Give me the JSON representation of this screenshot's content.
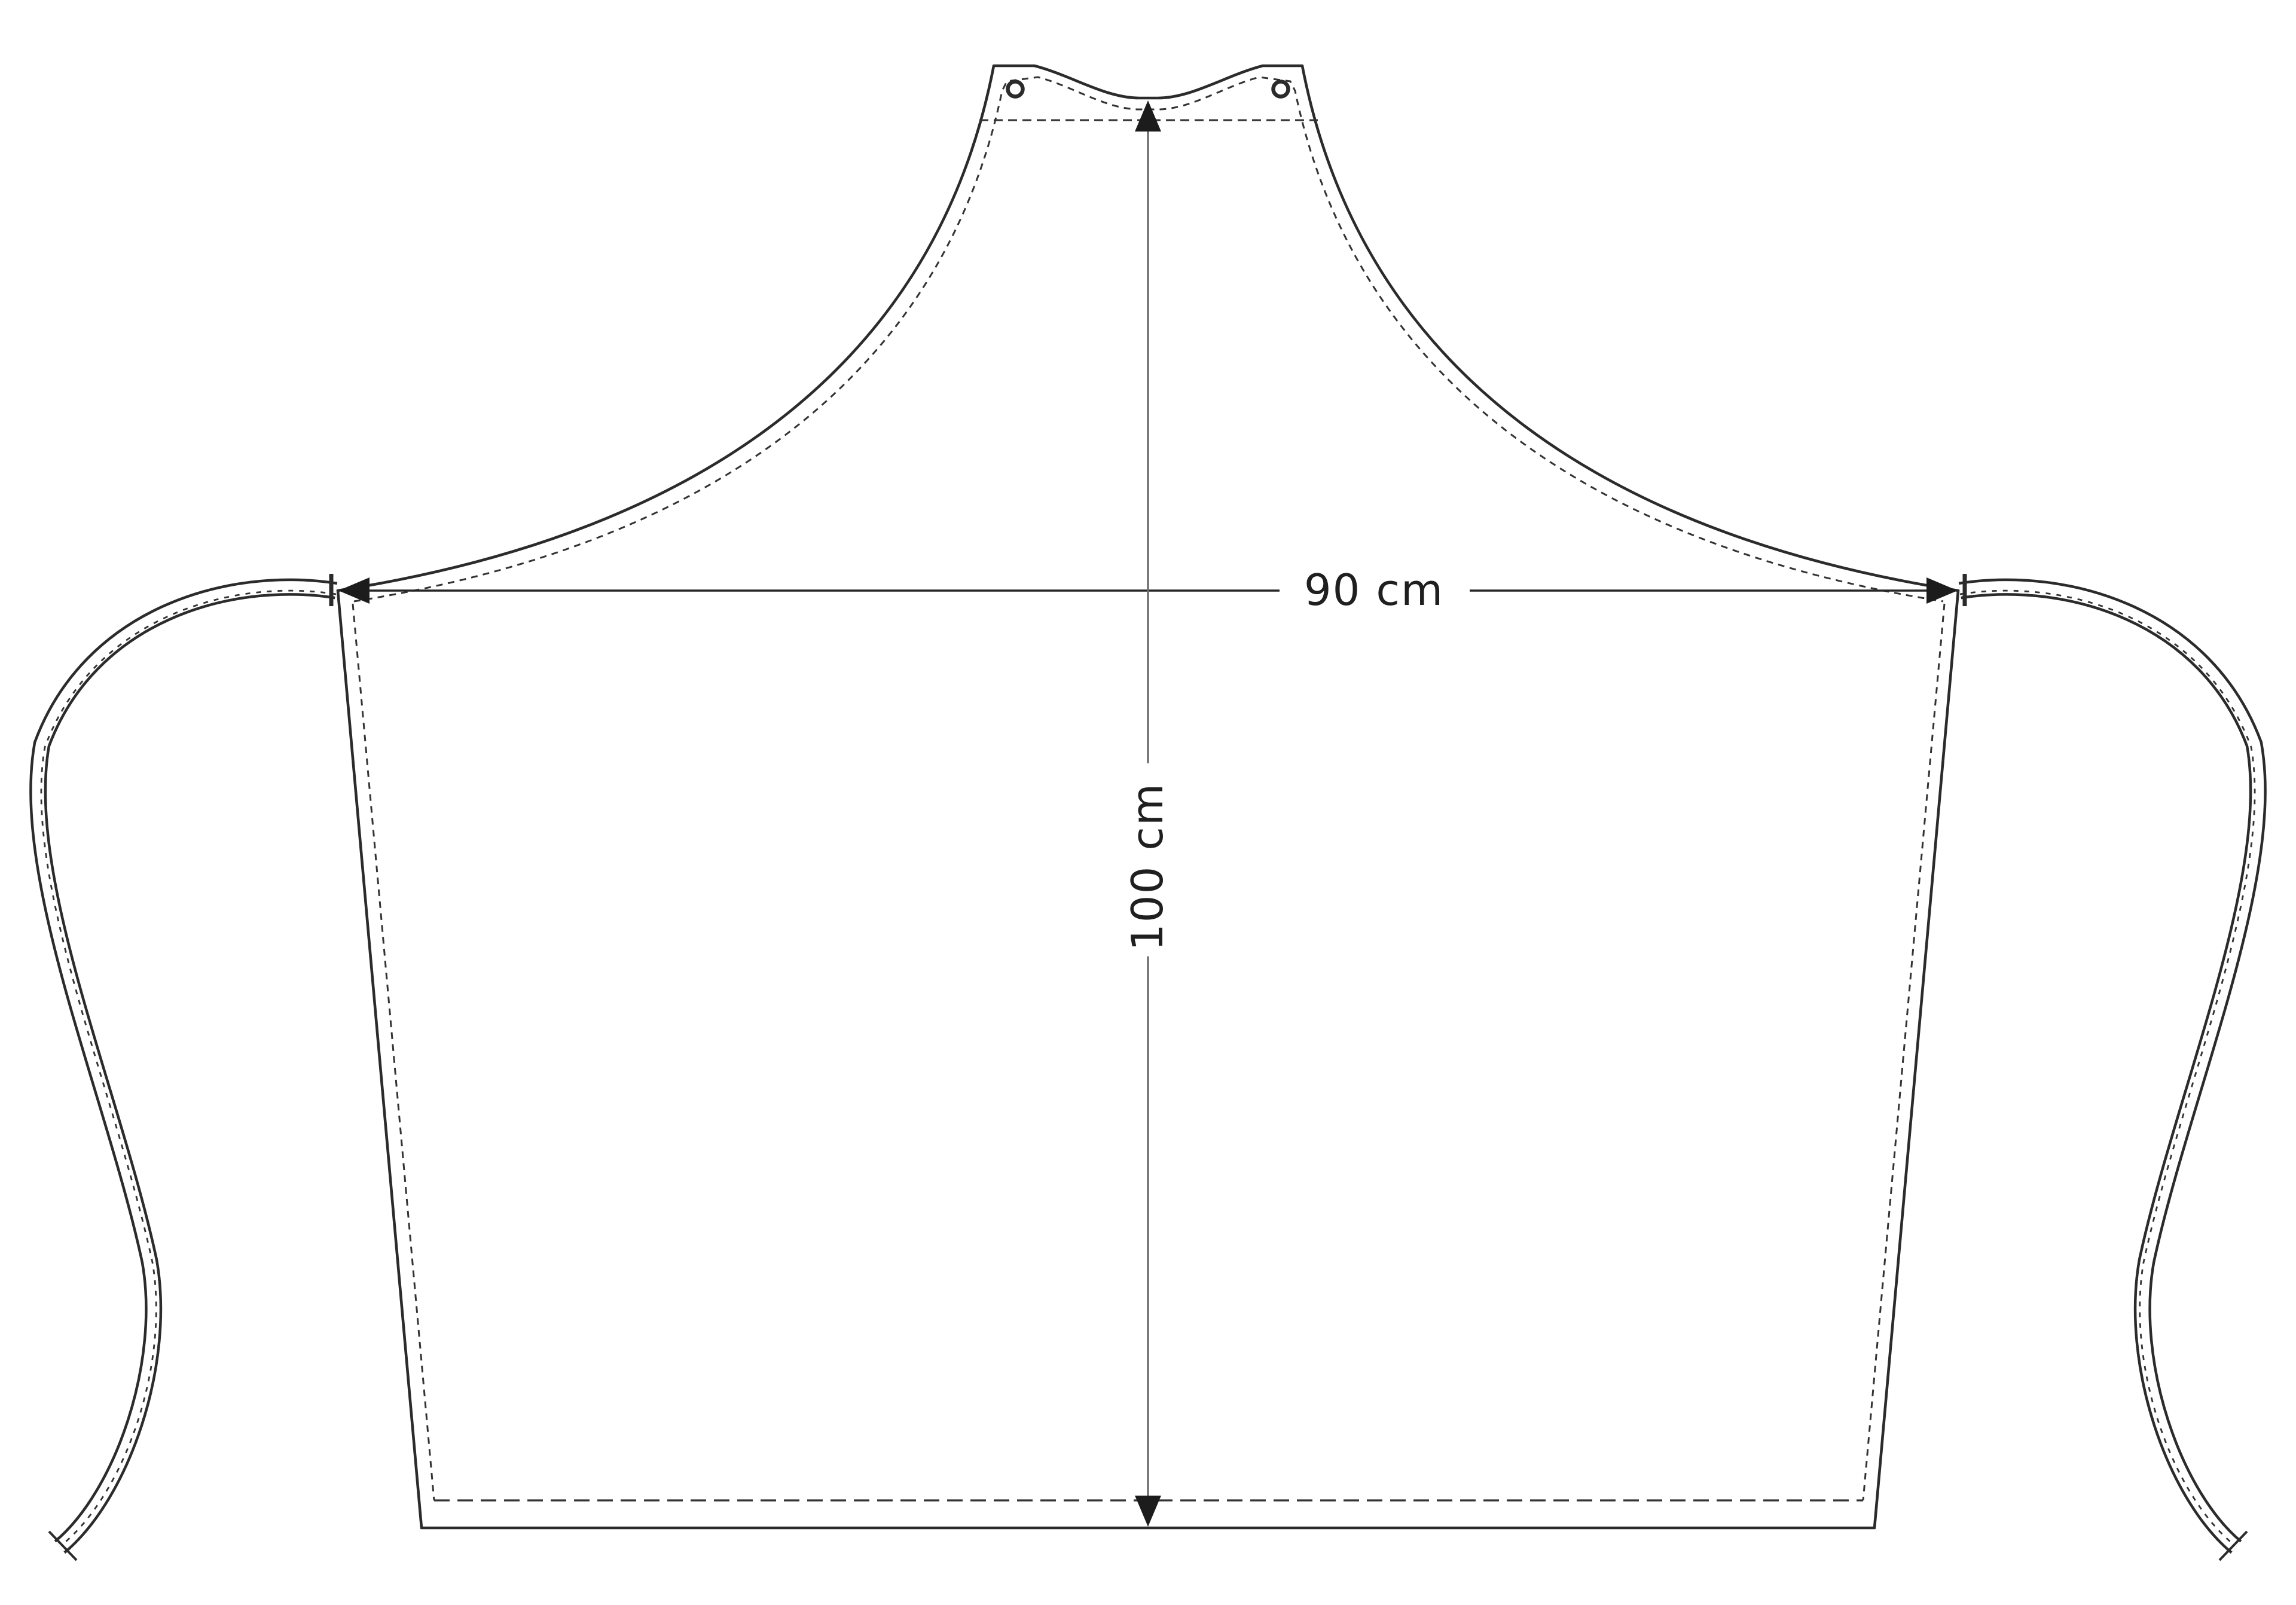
{
  "figure": {
    "title": "Apron pattern diagram with dimensions",
    "colors": {
      "paper": "#ffffff",
      "ink": "#2b2b2b",
      "dash": "#333333",
      "dimh": "#262626",
      "dimv": "#6b6b6b",
      "arrow": "#1c1c1c",
      "text": "#1f1f1f"
    }
  },
  "dimensions": {
    "width": {
      "label": "90 cm",
      "value": 90,
      "unit": "cm",
      "orientation": "horizontal"
    },
    "height": {
      "label": "100 cm",
      "value": 100,
      "unit": "cm",
      "orientation": "vertical"
    }
  }
}
